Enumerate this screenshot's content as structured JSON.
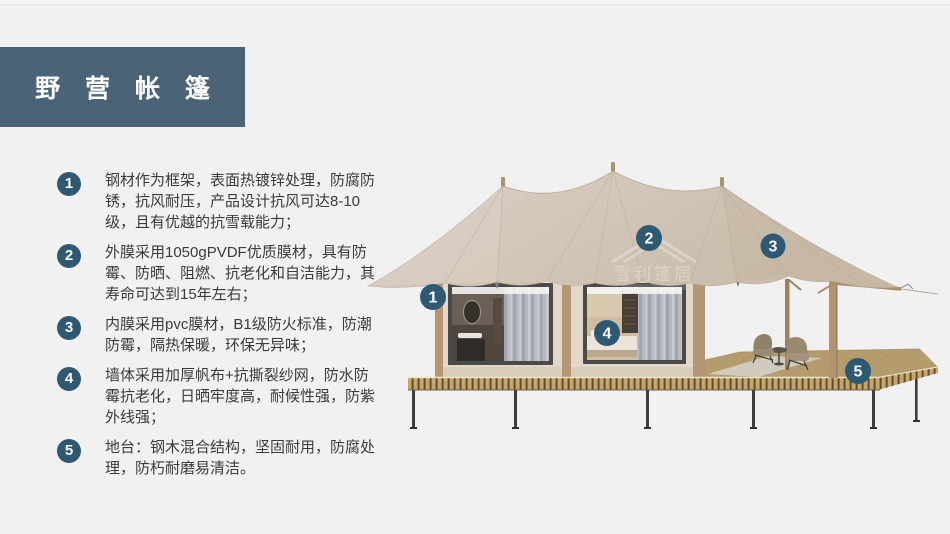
{
  "slide": {
    "title": "野 营 帐 篷",
    "colors": {
      "background": "#f1f1f2",
      "title_block": "#4a6377",
      "badge": "#2d5a72",
      "body_text": "#3b3b3b",
      "canopy": "#d3c7b8",
      "cabin_wall": "#e2d8c8",
      "deck_slat": "#c9a667",
      "leg": "#3a3e44"
    },
    "features": [
      {
        "num": "1",
        "text": "钢材作为框架，表面热镀锌处理，防腐防锈，抗风耐压，产品设计抗风可达8-10级，且有优越的抗雪载能力；"
      },
      {
        "num": "2",
        "text": "外膜采用1050gPVDF优质膜材，具有防霉、防晒、阻燃、抗老化和自洁能力，其寿命可达到15年左右；"
      },
      {
        "num": "3",
        "text": "内膜采用pvc膜材，B1级防火标准，防潮防霉，隔热保暖，环保无异味；"
      },
      {
        "num": "4",
        "text": "墙体采用加厚帆布+抗撕裂纱网，防水防霉抗老化，日晒牢度高，耐候性强，防紫外线强；"
      },
      {
        "num": "5",
        "text": "地台：钢木混合结构，坚固耐用，防腐处理，防朽耐磨易清洁。"
      }
    ],
    "callouts": [
      "1",
      "2",
      "3",
      "4",
      "5"
    ],
    "watermark": {
      "icon": "roof-outline-icon",
      "text": "雪利篷居"
    }
  }
}
